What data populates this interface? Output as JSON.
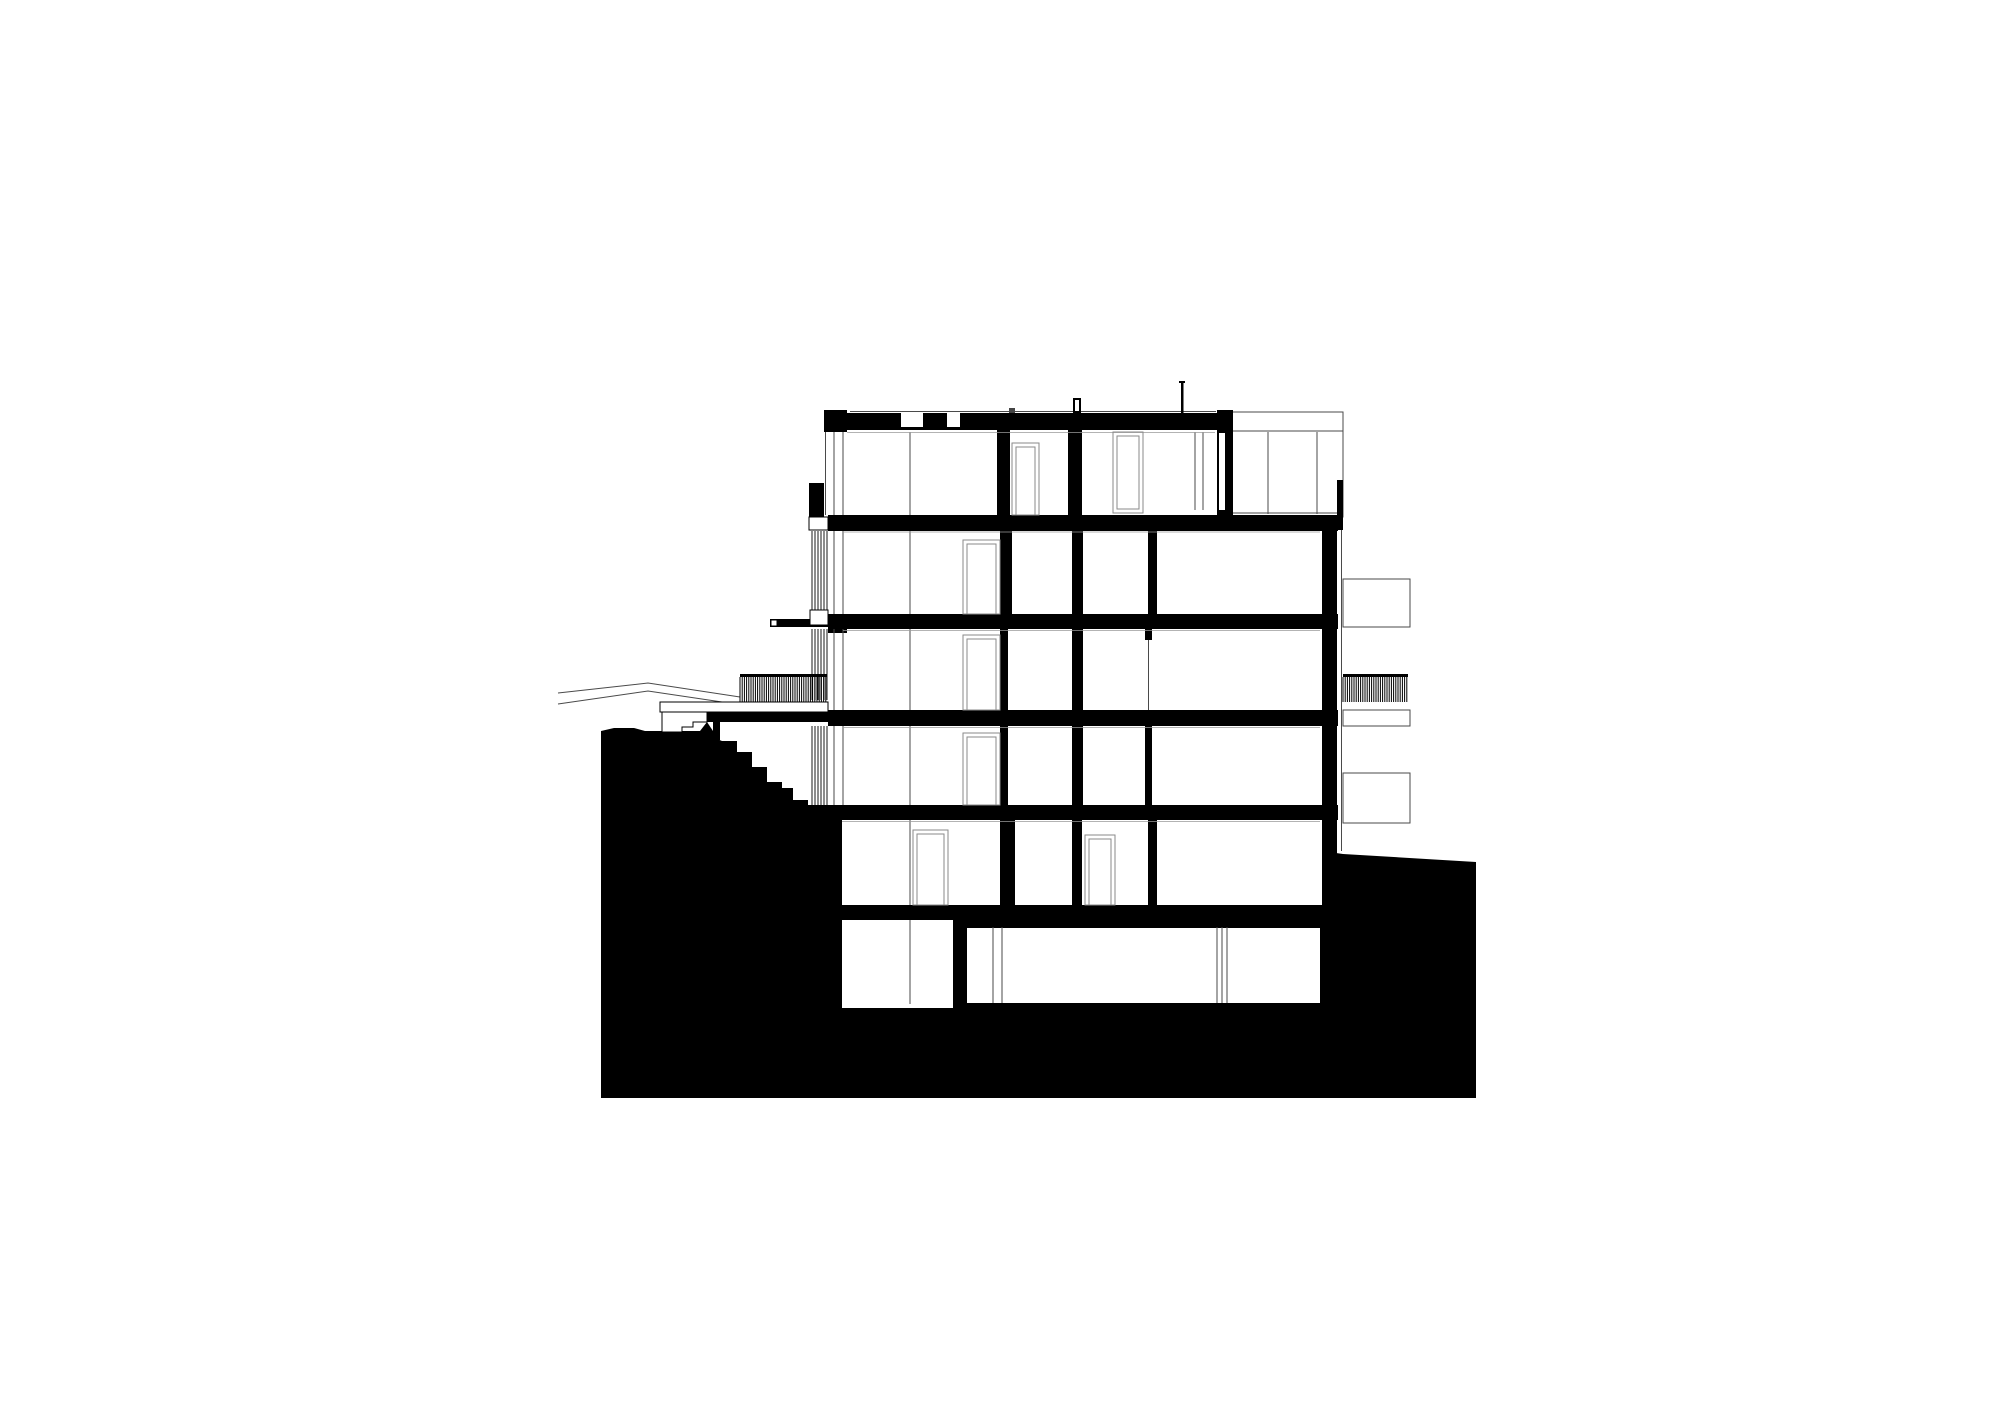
{
  "document": {
    "type": "architectural-section-drawing",
    "subject": "building-cross-section-on-hillside"
  },
  "colors": {
    "ink": "#000000",
    "paper": "#ffffff",
    "line": "#4a4a4a",
    "faint": "#9a9a9a",
    "frame": "#8a8a8a"
  },
  "canvas": {
    "width": 2000,
    "height": 1415
  },
  "drawing": {
    "terrain": {
      "points": "601,731 614,728 634,728 645,731 700,731 700,732 722,741 737,741 737,752 752,752 752,767 767,767 767,782 782,782 782,788 793,788 793,800 808,800 808,820 1336,820 1336,853 1343,854 1476,862 1476,1098 601,1098"
    },
    "background": {
      "gables": [
        "558,693 648,683 740,697",
        "558,704 648,691 722,702"
      ],
      "volume": {
        "rect": [
          1229,
          412,
          114,
          105
        ],
        "hlines": [
          [
            1229,
            431,
            1343
          ],
          [
            1229,
            513,
            1343
          ]
        ],
        "vlines": [
          [
            1268,
            432,
            514
          ],
          [
            1317,
            432,
            514
          ]
        ]
      },
      "facade_line": [
        1341.5,
        517,
        851
      ],
      "roof_line": [
        850,
        411.5,
        1216
      ],
      "boxes": [
        [
          1343,
          579,
          67,
          48
        ],
        [
          1343,
          710,
          67,
          16
        ],
        [
          1343,
          773,
          67,
          50
        ]
      ],
      "interior_lines": [
        [
          1304,
          820,
          905
        ],
        [
          1304,
          927,
          1003
        ]
      ]
    },
    "rooms": [
      [
        842,
        820,
        158,
        85
      ],
      [
        1015,
        820,
        57,
        85
      ],
      [
        1082,
        820,
        66,
        85
      ],
      [
        1157,
        820,
        165,
        85
      ],
      [
        842,
        920,
        111,
        88
      ],
      [
        967,
        927,
        353,
        76
      ]
    ],
    "steps": {
      "points": "707,712 707,722 693,722 693,727 682,727 682,732 662,732 662,712"
    },
    "walkway": [
      660,
      702,
      168,
      10
    ],
    "black": [
      [
        824,
        413,
        409,
        17
      ],
      [
        824,
        410,
        23,
        22
      ],
      [
        1217,
        410,
        16,
        20
      ],
      [
        828,
        515,
        510,
        16
      ],
      [
        1337,
        480,
        6,
        50
      ],
      [
        809,
        483,
        15,
        34
      ],
      [
        828,
        614,
        510,
        15
      ],
      [
        770,
        619,
        58,
        8
      ],
      [
        828,
        629,
        19,
        4
      ],
      [
        828,
        710,
        510,
        16
      ],
      [
        707,
        712,
        143,
        10
      ],
      [
        793,
        805,
        545,
        15
      ],
      [
        837,
        905,
        485,
        15
      ],
      [
        953,
        920,
        369,
        8
      ],
      [
        997,
        430,
        13,
        85
      ],
      [
        1068,
        430,
        14,
        85
      ],
      [
        1217,
        430,
        16,
        85
      ],
      [
        1000,
        531,
        12,
        83
      ],
      [
        1072,
        531,
        11,
        83
      ],
      [
        1148,
        531,
        9,
        83
      ],
      [
        1322,
        530,
        15,
        390
      ],
      [
        1000,
        629,
        8,
        81
      ],
      [
        1072,
        629,
        11,
        81
      ],
      [
        1145,
        629,
        7,
        11
      ],
      [
        1000,
        726,
        8,
        79
      ],
      [
        1072,
        726,
        11,
        79
      ],
      [
        1145,
        726,
        7,
        79
      ],
      [
        1000,
        820,
        15,
        85
      ],
      [
        1072,
        820,
        10,
        85
      ],
      [
        1148,
        820,
        9,
        85
      ],
      [
        953,
        920,
        14,
        88
      ],
      [
        1320,
        920,
        18,
        85
      ],
      [
        713,
        722,
        7,
        18
      ],
      [
        1073,
        398,
        8,
        15
      ],
      [
        740,
        674,
        87,
        3
      ],
      [
        1343,
        674,
        65,
        3
      ]
    ],
    "triangle": "693,740 707,722 719,740",
    "white_cuts": [
      [
        901,
        413,
        22,
        14
      ],
      [
        947,
        413,
        13,
        14
      ],
      [
        1219,
        433,
        6,
        77
      ],
      [
        1075,
        400,
        4,
        11
      ]
    ],
    "white_boxes": [
      [
        809,
        517,
        19,
        13
      ],
      [
        771,
        620,
        6,
        6
      ],
      [
        810,
        610,
        18,
        15
      ]
    ],
    "louvers": [
      {
        "rect": [
          812,
          531,
          15,
          79
        ],
        "spacing": 3
      },
      {
        "rect": [
          812,
          629,
          15,
          71
        ],
        "spacing": 3
      },
      {
        "rect": [
          812,
          726,
          15,
          80
        ],
        "spacing": 3
      }
    ],
    "hatches": [
      {
        "rect": [
          740,
          677,
          87,
          25
        ],
        "spacing": 2.2
      },
      {
        "rect": [
          1343,
          677,
          65,
          25
        ],
        "spacing": 2.2
      }
    ],
    "thin_lines": [
      {
        "x": 825.5,
        "segs": [
          [
            432,
            515
          ]
        ]
      },
      {
        "x": 834,
        "segs": [
          [
            432,
            515
          ],
          [
            531,
            614
          ],
          [
            629,
            710
          ],
          [
            726,
            805
          ]
        ]
      },
      {
        "x": 843,
        "segs": [
          [
            432,
            515
          ],
          [
            531,
            614
          ],
          [
            629,
            710
          ],
          [
            726,
            805
          ]
        ]
      },
      {
        "x": 910,
        "segs": [
          [
            432,
            515
          ],
          [
            531,
            614
          ],
          [
            629,
            710
          ],
          [
            726,
            805
          ],
          [
            820,
            905
          ],
          [
            920,
            1004
          ]
        ]
      },
      {
        "x": 1195,
        "segs": [
          [
            432,
            510
          ]
        ]
      },
      {
        "x": 1203,
        "segs": [
          [
            432,
            510
          ]
        ]
      },
      {
        "x": 1148.5,
        "segs": [
          [
            640,
            710
          ]
        ]
      },
      {
        "x": 993,
        "segs": [
          [
            927,
            1003
          ]
        ]
      },
      {
        "x": 1002,
        "segs": [
          [
            927,
            1003
          ]
        ]
      },
      {
        "x": 1217,
        "segs": [
          [
            927,
            1003
          ]
        ]
      },
      {
        "x": 1222,
        "segs": [
          [
            927,
            1003
          ]
        ]
      },
      {
        "x": 1227,
        "segs": [
          [
            927,
            1003
          ]
        ]
      }
    ],
    "ceiling_lines": [
      [
        847,
        432.5,
        1215
      ],
      [
        843,
        532,
        1320
      ],
      [
        843,
        630.5,
        1320
      ],
      [
        843,
        727.5,
        1320
      ],
      [
        842,
        821.5,
        1320
      ]
    ],
    "frames": [
      {
        "rect": [
          1012,
          443,
          27,
          72
        ],
        "kind": "door"
      },
      {
        "rect": [
          1113,
          432,
          30,
          81
        ],
        "kind": "window"
      },
      {
        "rect": [
          963,
          540,
          37,
          74
        ],
        "kind": "door"
      },
      {
        "rect": [
          963,
          635,
          37,
          75
        ],
        "kind": "door"
      },
      {
        "rect": [
          963,
          733,
          37,
          72
        ],
        "kind": "door"
      },
      {
        "rect": [
          913,
          830,
          35,
          75
        ],
        "kind": "door"
      },
      {
        "rect": [
          1085,
          835,
          30,
          70
        ],
        "kind": "door"
      }
    ],
    "markers": {
      "chimney": [
        1073,
        398,
        8,
        15
      ],
      "vent": [
        1009,
        408,
        6,
        5
      ],
      "post": [
        1181,
        381,
        2.5,
        32
      ],
      "post_cap": [
        1179,
        381,
        6,
        2
      ]
    }
  }
}
